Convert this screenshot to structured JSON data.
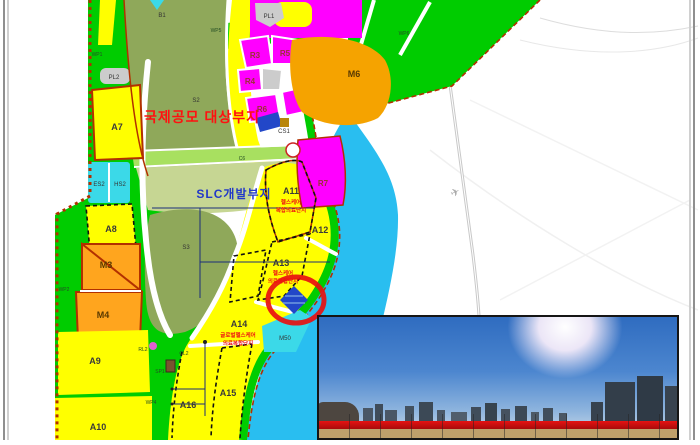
{
  "palette": {
    "parcel_yellow": "#FFFF00",
    "road_green": "#00CC00",
    "olive": "#8FA85A",
    "pale_olive": "#C6D693",
    "water_blue": "#29BEF0",
    "residential_magenta": "#FF00FF",
    "industrial_orange": "#F5A300",
    "cyan_parcel": "#3BD9E8",
    "navy_parcel": "#2247C8",
    "gray_parcel": "#CCCCCC",
    "boundary_red_brown": "#B23000",
    "highlight_circle_red": "#E81010",
    "title_red": "#FF1010",
    "title_blue": "#2238C8"
  },
  "map": {
    "titles": {
      "competition": "국제공모 대상부지",
      "slc": "SLC개발부지"
    },
    "parcels": {
      "a7": "A7",
      "a8": "A8",
      "a9": "A9",
      "a10": "A10",
      "a11": "A11",
      "a12": "A12",
      "a13": "A13",
      "a14": "A14",
      "a15": "A15",
      "a16": "A16",
      "m3": "M3",
      "m4": "M4",
      "m6": "M6",
      "r3": "R3",
      "r4": "R4",
      "r5": "R5",
      "r6": "R6",
      "r7": "R7"
    },
    "zones": {
      "b1": "B1",
      "s2": "S2",
      "s3": "S3",
      "es2": "ES2",
      "hs2": "HS2",
      "m50": "M50",
      "cs1": "CS1",
      "pl1": "PL1",
      "pl2": "PL2"
    },
    "roads": {
      "c6": "C6",
      "rl2": "RL2",
      "cl2": "CL2",
      "sp1": "SP1",
      "wp1": "WP1",
      "wp2": "WP2",
      "wp4": "WP4",
      "wp5": "WP5",
      "wp6": "WP6"
    },
    "notes": {
      "a11": [
        "헬스케어",
        "복합의료단지"
      ],
      "a13": [
        "헬스케어",
        "의료복합단지"
      ],
      "a14": [
        "글로벌헬스케어",
        "의료복합단지"
      ]
    }
  }
}
